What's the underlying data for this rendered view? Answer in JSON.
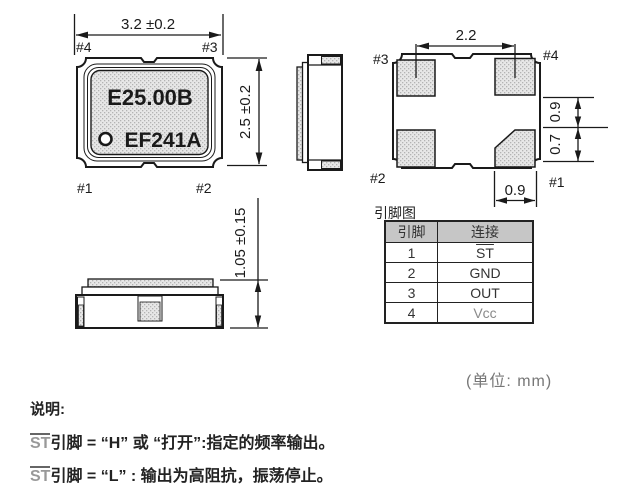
{
  "colors": {
    "line": "#1a1a1a",
    "pad_fill": "#e7e7e7",
    "pad_dot": "#b3b3b3",
    "table_header_bg": "#c6c6c6",
    "muted_text": "#777777"
  },
  "top_view": {
    "dim_width": "3.2 ±0.2",
    "dim_height": "2.5 ±0.2",
    "pin_top_left": "#4",
    "pin_top_right": "#3",
    "pin_bottom_left": "#1",
    "pin_bottom_right": "#2",
    "marking_line1": "E25.00B",
    "marking_line2": "EF241A"
  },
  "bottom_view": {
    "dim_pad_span": "2.2",
    "dim_right_upper": "0.9",
    "dim_right_lower": "0.7",
    "dim_pad_width": "0.9",
    "pin_top_left": "#3",
    "pin_top_right": "#4",
    "pin_bottom_left": "#2",
    "pin_bottom_right": "#1"
  },
  "front_view": {
    "dim_height": "1.05 ±0.15"
  },
  "pin_table": {
    "title": "引脚图",
    "headers": [
      "引脚",
      "连接"
    ],
    "rows": [
      {
        "pin": "1",
        "connection": "ST"
      },
      {
        "pin": "2",
        "connection": "GND"
      },
      {
        "pin": "3",
        "connection": "OUT"
      },
      {
        "pin": "4",
        "connection": "Vcc"
      }
    ]
  },
  "unit_label": "(单位: mm)",
  "notes": {
    "heading": "说明:",
    "line1": {
      "st": "ST",
      "text": "引脚 = “H” 或 “打开”:指定的频率输出。"
    },
    "line2": {
      "st": "ST",
      "text": "引脚 = “L” : 输出为高阻抗，振荡停止。"
    }
  }
}
